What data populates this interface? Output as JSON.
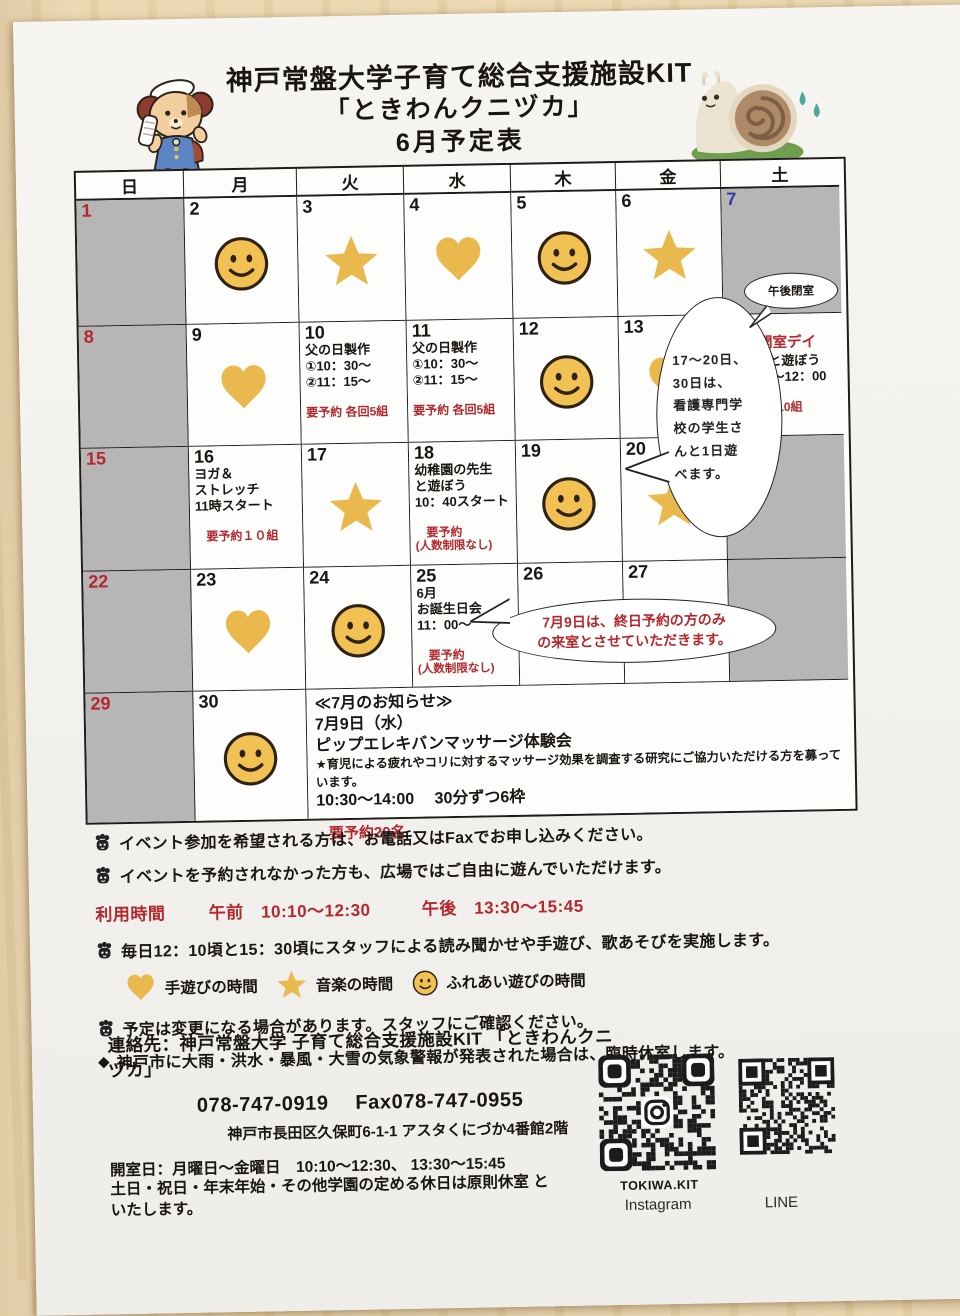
{
  "header": {
    "title1": "神戸常盤大学子育て総合支援施設KIT",
    "title2": "「ときわんクニヅカ」",
    "title3": "6月予定表"
  },
  "colors": {
    "accent_red": "#b3282e",
    "accent_blue": "#2b3f9e",
    "icon_gold": "#e9b94e",
    "closed_gray": "#b7b5b6"
  },
  "calendar": {
    "weekday_headers": [
      "日",
      "月",
      "火",
      "水",
      "木",
      "金",
      "土"
    ],
    "cells": [
      {
        "num": "1",
        "num_color": "red",
        "bg": "gray"
      },
      {
        "num": "2",
        "icon": "smiley"
      },
      {
        "num": "3",
        "icon": "star"
      },
      {
        "num": "4",
        "icon": "heart"
      },
      {
        "num": "5",
        "icon": "smiley"
      },
      {
        "num": "6",
        "icon": "star"
      },
      {
        "num": "7",
        "num_color": "blue",
        "bg": "gray",
        "oval": "午後閉室"
      },
      {
        "num": "8",
        "num_color": "red",
        "bg": "gray"
      },
      {
        "num": "9",
        "icon": "heart"
      },
      {
        "num": "10",
        "lines": [
          {
            "t": "父の日製作"
          },
          {
            "t": "①10：30～"
          },
          {
            "t": "②11：15～"
          },
          {
            "t": "要予約 各回5組",
            "c": "r",
            "gap": true
          }
        ]
      },
      {
        "num": "11",
        "lines": [
          {
            "t": "父の日製作"
          },
          {
            "t": "①10：30～"
          },
          {
            "t": "②11：15～"
          },
          {
            "t": "要予約 各回5組",
            "c": "r",
            "gap": true
          }
        ]
      },
      {
        "num": "12",
        "icon": "smiley"
      },
      {
        "num": "13",
        "icon": "heart"
      },
      {
        "num": "14",
        "num_color": "blue",
        "lines": [
          {
            "t": "土曜開室デイ",
            "c": "rh"
          },
          {
            "t": "大学生と遊ぼう"
          },
          {
            "t": "10：30～12：00"
          },
          {
            "t": "要予約10組",
            "c": "r",
            "gap": true,
            "ind": true
          }
        ]
      },
      {
        "num": "15",
        "num_color": "red",
        "bg": "gray"
      },
      {
        "num": "16",
        "lines": [
          {
            "t": "ヨガ＆"
          },
          {
            "t": "ストレッチ"
          },
          {
            "t": "11時スタート"
          },
          {
            "t": "要予約１０組",
            "c": "r",
            "gap": true,
            "ind": true
          }
        ]
      },
      {
        "num": "17",
        "icon": "star"
      },
      {
        "num": "18",
        "lines": [
          {
            "t": "幼稚園の先生"
          },
          {
            "t": "と遊ぼう"
          },
          {
            "t": "10：40スタート"
          },
          {
            "t": "要予約",
            "c": "r",
            "gap": true,
            "ind": true
          },
          {
            "t": "(人数制限なし)",
            "c": "r",
            "sm": true
          }
        ]
      },
      {
        "num": "19",
        "icon": "smiley"
      },
      {
        "num": "20",
        "icon": "star"
      },
      {
        "num": "21",
        "num_color": "blue",
        "bg": "gray"
      },
      {
        "num": "22",
        "num_color": "red",
        "bg": "gray"
      },
      {
        "num": "23",
        "icon": "heart"
      },
      {
        "num": "24",
        "icon": "smiley"
      },
      {
        "num": "25",
        "lines": [
          {
            "t": "6月"
          },
          {
            "t": "お誕生日会"
          },
          {
            "t": "11：00～"
          },
          {
            "t": "要予約",
            "c": "r",
            "gap": true,
            "ind": true
          },
          {
            "t": "(人数制限なし)",
            "c": "r",
            "sm": true
          }
        ]
      },
      {
        "num": "26",
        "icon": "heart"
      },
      {
        "num": "27",
        "icon": "star"
      },
      {
        "num": "",
        "bg": "gray"
      },
      {
        "num": "29",
        "num_color": "red",
        "bg": "gray"
      },
      {
        "num": "30",
        "icon": "smiley"
      }
    ]
  },
  "july_notice": {
    "title": "≪7月のお知らせ≫",
    "date": "7月9日（水）",
    "event": "ピップエレキバンマッサージ体験会",
    "detail": "★育児による疲れやコリに対するマッサージ効果を調査する研究にご協力いただける方を募っています。",
    "time": "10:30～14:00　 30分ずつ6枠",
    "reserve": "要予約20名"
  },
  "bubbles": {
    "day7_oval": "午後閉室",
    "nursing": [
      "17～20日、",
      "30日は、",
      "看護専門学",
      "校の学生さ",
      "んと1日遊",
      "べます。"
    ],
    "july9": [
      "7月9日は、終日予約の方のみ",
      "の来室とさせていただきます。"
    ]
  },
  "notes": [
    {
      "text": "イベント参加を希望される方は、お電話又はFaxでお申し込みください。"
    },
    {
      "text": "イベントを予約されなかった方も、広場ではご自由に遊んでいただけます。"
    },
    {
      "text": "毎日12：10頃と15：30頃にスタッフによる読み聞かせや手遊び、歌あそびを実施します。"
    },
    {
      "text": "予定は変更になる場合があります。スタッフにご確認ください。"
    },
    {
      "bullet": "◆",
      "text": "神戸市に大雨・洪水・暴風・大雪の気象警報が発表された場合は、臨時休室します。"
    }
  ],
  "hours": {
    "label": "利用時間",
    "am": "午前　10:10～12:30",
    "pm": "午後　13:30～15:45"
  },
  "legend": [
    {
      "icon": "heart",
      "label": "手遊びの時間"
    },
    {
      "icon": "star",
      "label": "音楽の時間"
    },
    {
      "icon": "smiley",
      "label": "ふれあい遊びの時間"
    }
  ],
  "contact": {
    "line1": "連絡先：神戸常盤大学 子育て総合支援施設KIT 「ときわんクニヅカ」",
    "line2": "078-747-0919　 Fax078-747-0955",
    "line3": "神戸市長田区久保町6-1-1 アスタくにづか4番館2階",
    "line4": "開室日：月曜日～金曜日　10:10～12:30、 13:30～15:45",
    "line5": "土日・祝日・年末年始・その他学園の定める休日は原則休室 と",
    "line6": "いたします。"
  },
  "qr": {
    "instagram_caption": "TOKIWA.KIT",
    "instagram_label": "Instagram",
    "line_label": "LINE"
  }
}
